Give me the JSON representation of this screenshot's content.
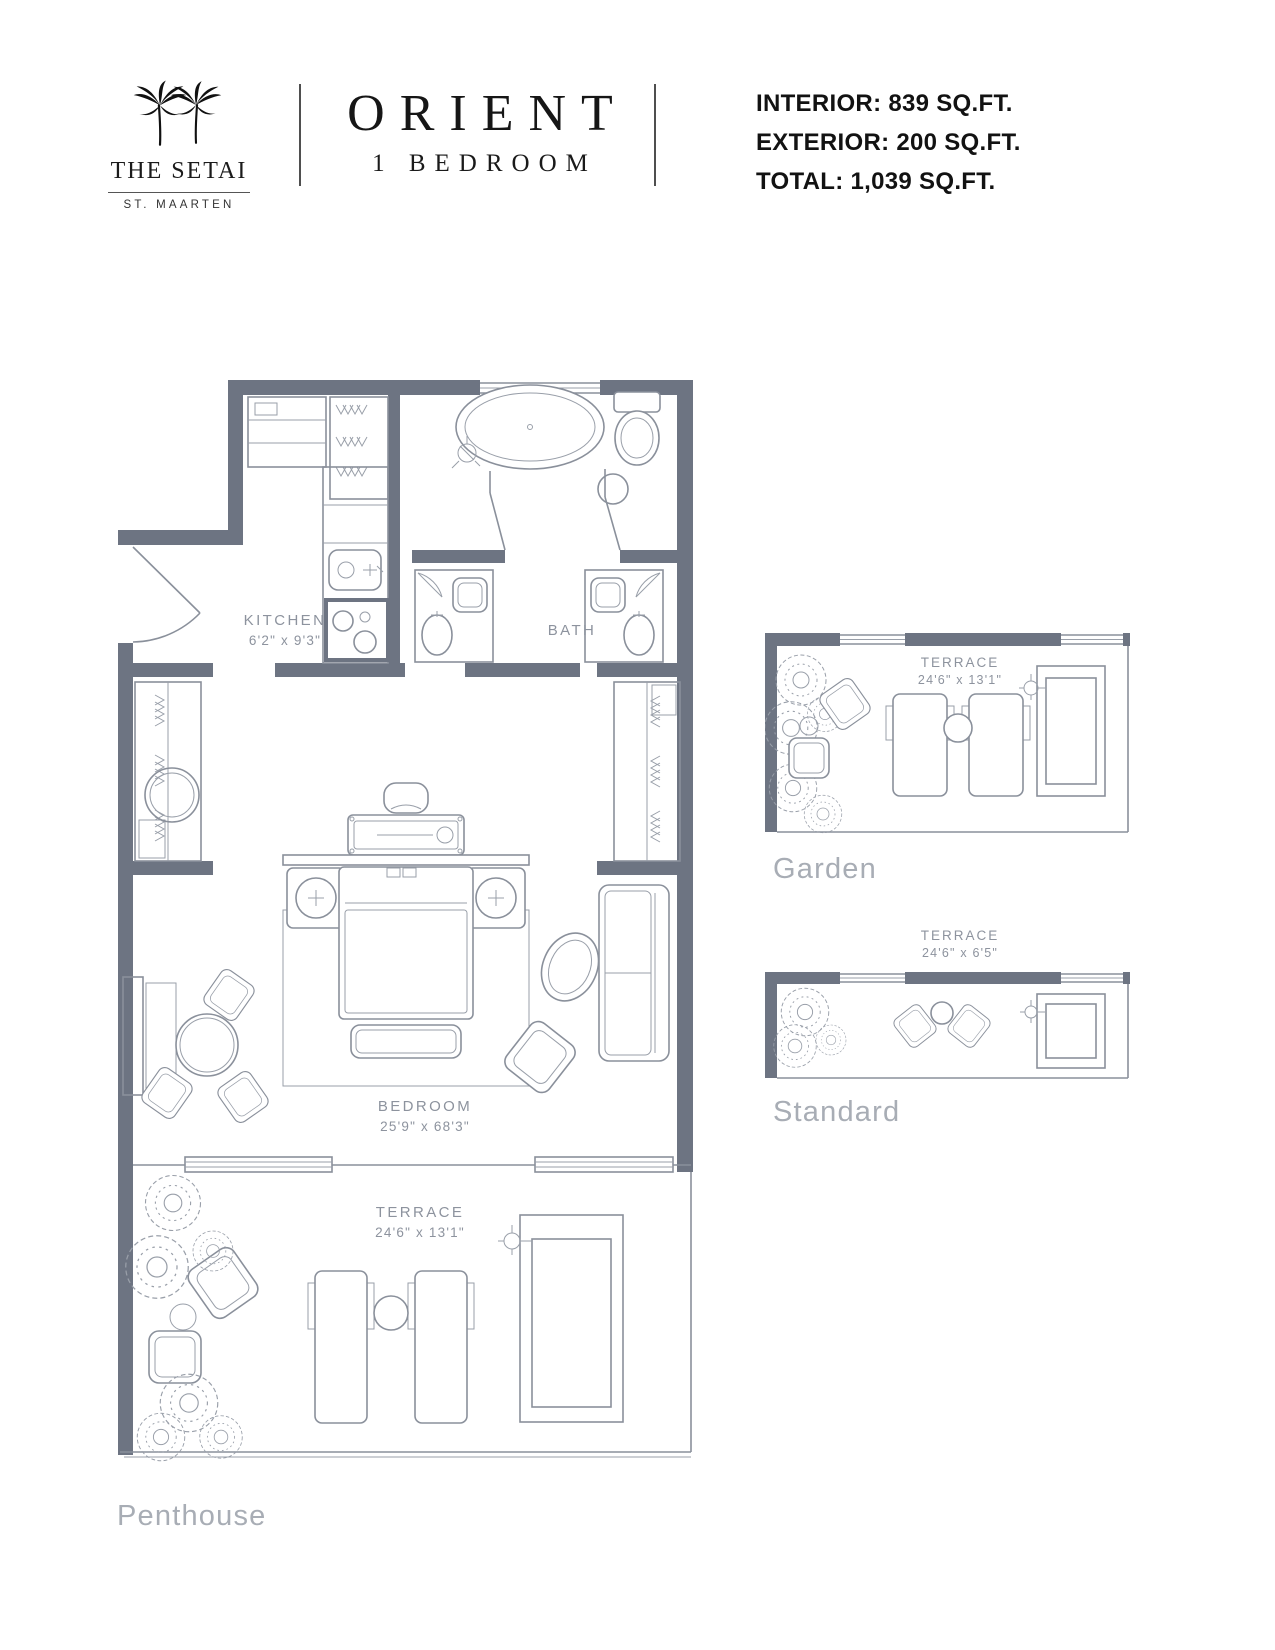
{
  "colors": {
    "wall": "#6d7482",
    "line": "#8a909b",
    "room_label": "#8d939e",
    "caption": "#a8adb5",
    "ink": "#111111"
  },
  "header": {
    "logo": {
      "name": "THE SETAI",
      "location": "ST. MAARTEN",
      "icon": "palm-trees-icon"
    },
    "title": "ORIENT",
    "subtitle": "1 BEDROOM",
    "stats": {
      "interior": "INTERIOR: 839 SQ.FT.",
      "exterior": "EXTERIOR: 200 SQ.FT.",
      "total": "TOTAL: 1,039 SQ.FT."
    }
  },
  "penthouse": {
    "caption": "Penthouse",
    "kitchen_label": "KITCHEN",
    "kitchen_dims": "6'2\" x 9'3\"",
    "bath_label": "BATH",
    "bedroom_label": "BEDROOM",
    "bedroom_dims": "25'9\" x 68'3\"",
    "terrace_label": "TERRACE",
    "terrace_dims": "24'6\" x 13'1\""
  },
  "garden": {
    "caption": "Garden",
    "terrace_label": "TERRACE",
    "terrace_dims": "24'6\" x 13'1\""
  },
  "standard": {
    "caption": "Standard",
    "terrace_label": "TERRACE",
    "terrace_dims": "24'6\" x 6'5\""
  }
}
